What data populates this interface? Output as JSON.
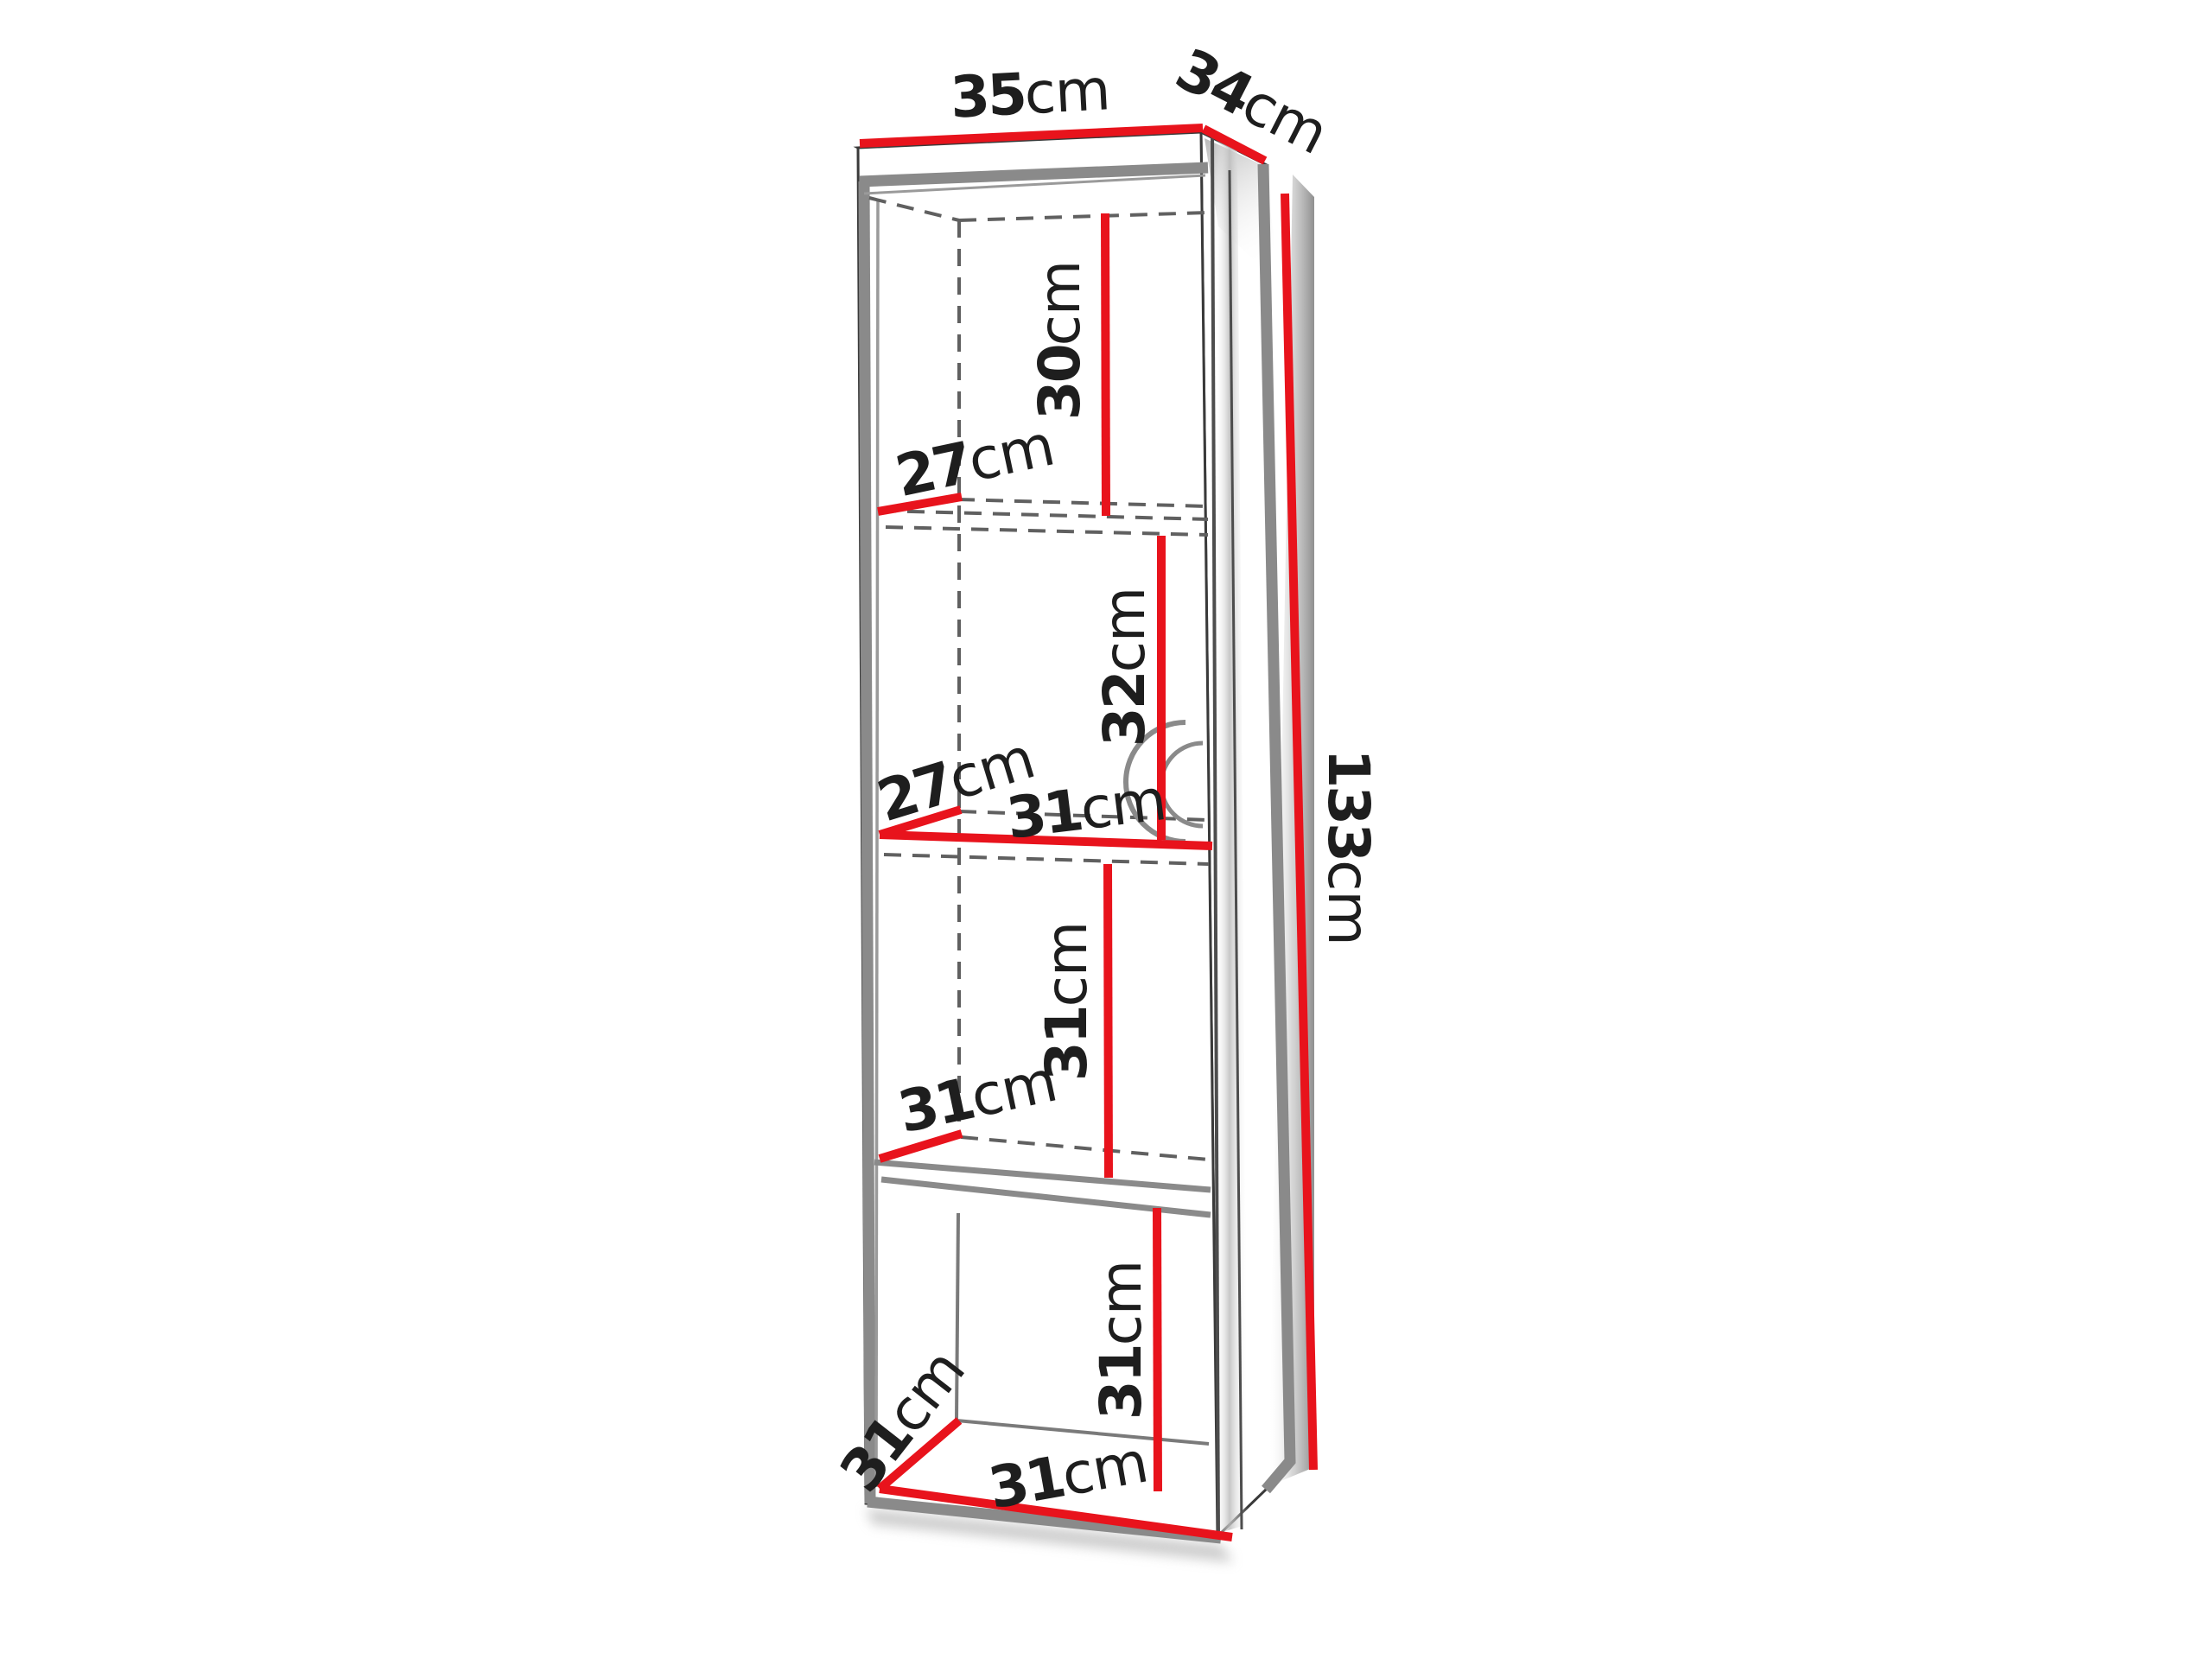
{
  "diagram": {
    "type": "furniture-dimension-drawing",
    "subject": "tall open shelving cabinet with four compartments",
    "colors": {
      "background": "#ffffff",
      "dimension_red": "#e8131c",
      "structure_gray": "#8a8a8a",
      "hidden_dash_gray": "#606060",
      "text": "#1e1e1e"
    },
    "labels": {
      "width_top": {
        "value": "35",
        "unit": "cm"
      },
      "depth_top": {
        "value": "34",
        "unit": "cm"
      },
      "height_total": {
        "value": "133",
        "unit": "cm"
      },
      "compartment_1_height": {
        "value": "30",
        "unit": "cm"
      },
      "shelf_1_depth": {
        "value": "27",
        "unit": "cm"
      },
      "compartment_2_height": {
        "value": "32",
        "unit": "cm"
      },
      "shelf_2_depth": {
        "value": "27",
        "unit": "cm"
      },
      "shelf_2_width": {
        "value": "31",
        "unit": "cm"
      },
      "compartment_3_height": {
        "value": "31",
        "unit": "cm"
      },
      "shelf_3_depth": {
        "value": "31",
        "unit": "cm"
      },
      "compartment_4_height": {
        "value": "31",
        "unit": "cm"
      },
      "bottom_depth": {
        "value": "31",
        "unit": "cm"
      },
      "bottom_width": {
        "value": "31",
        "unit": "cm"
      }
    }
  }
}
